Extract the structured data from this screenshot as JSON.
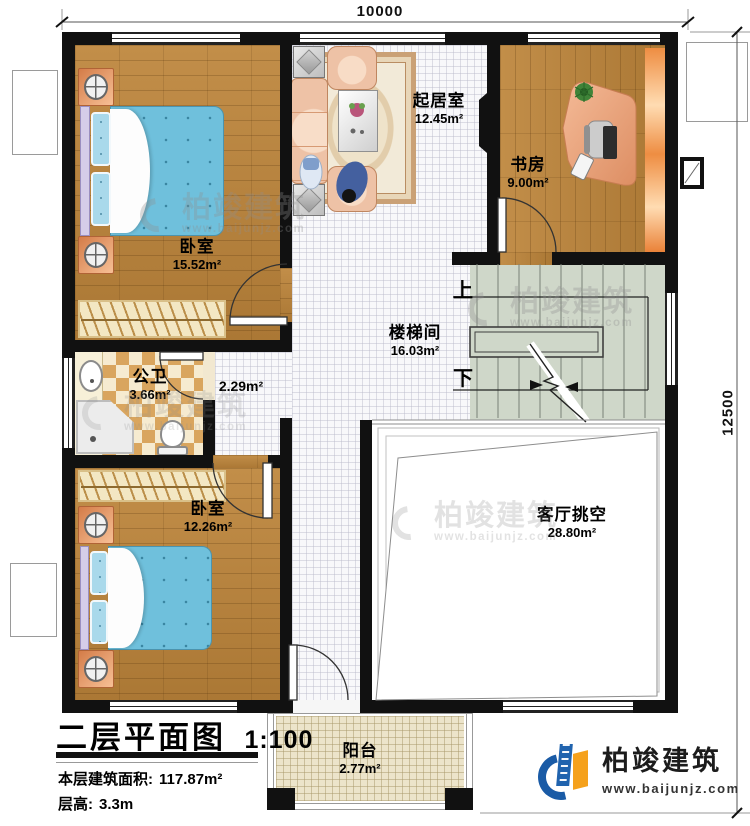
{
  "dimensions": {
    "width_top": "10000",
    "height_right": "12500"
  },
  "rooms": [
    {
      "name": "卧室",
      "area": "15.52m²"
    },
    {
      "name": "起居室",
      "area": "12.45m²"
    },
    {
      "name": "书房",
      "area": "9.00m²"
    },
    {
      "name": "楼梯间",
      "area": "16.03m²"
    },
    {
      "name": "公卫",
      "area": "3.66m²"
    },
    {
      "name": "",
      "area": "2.29m²"
    },
    {
      "name": "卧室",
      "area": "12.26m²"
    },
    {
      "name": "客厅挑空",
      "area": "28.80m²"
    },
    {
      "name": "阳台",
      "area": "2.77m²"
    }
  ],
  "stairs": {
    "up_label": "上",
    "down_label": "下"
  },
  "title_block": {
    "title": "二层平面图",
    "scale": "1:100",
    "floor_area_label": "本层建筑面积:",
    "floor_area_value": "117.87m²",
    "floor_height_label": "层高:",
    "floor_height_value": "3.3m"
  },
  "brand": {
    "name": "柏竣建筑",
    "website": "www.baijunjz.com"
  },
  "watermark": {
    "name": "柏竣建筑",
    "website": "www.baijunjz.com"
  },
  "colors": {
    "wall": "#111111",
    "wood": "#b8853f",
    "stair": "#cfd7c9",
    "balcony": "#ece4ca",
    "bed_blue": "#6fc0dc",
    "brand_blue": "#1a5ba6",
    "brand_orange": "#f5a11c"
  }
}
